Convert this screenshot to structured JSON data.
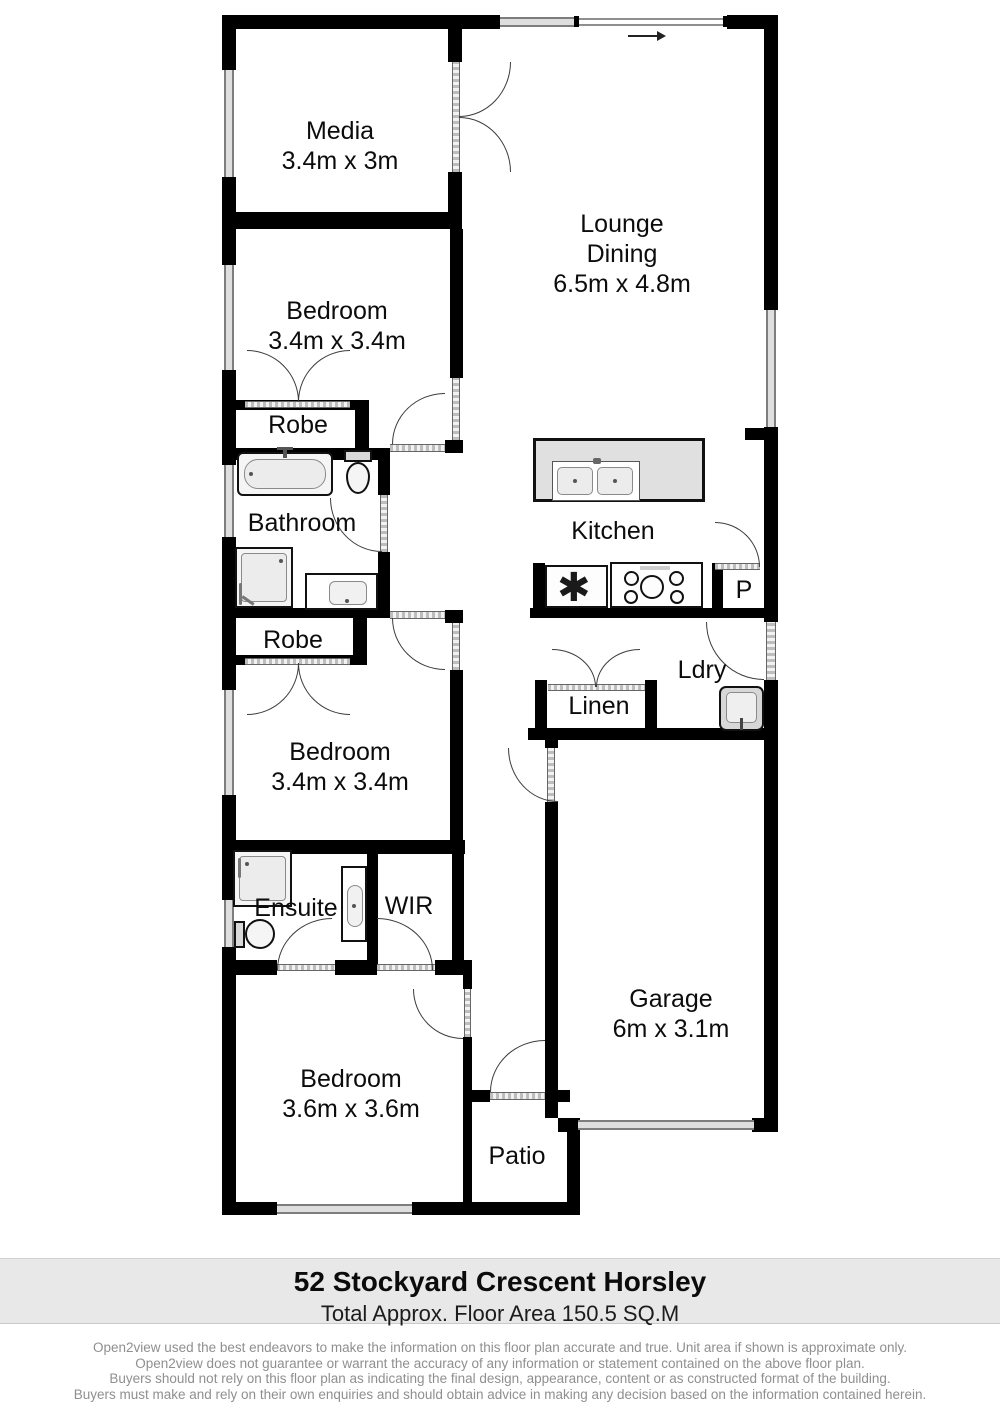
{
  "plan_title": "Floor plan",
  "rooms": {
    "media": {
      "name": "Media",
      "dims": "3.4m x 3m"
    },
    "lounge": {
      "name": "Lounge",
      "name2": "Dining",
      "dims": "6.5m x 4.8m"
    },
    "bedroom1": {
      "name": "Bedroom",
      "dims": "3.4m x 3.4m"
    },
    "robe1": {
      "name": "Robe"
    },
    "bathroom": {
      "name": "Bathroom"
    },
    "robe2": {
      "name": "Robe"
    },
    "bedroom2": {
      "name": "Bedroom",
      "dims": "3.4m x 3.4m"
    },
    "kitchen": {
      "name": "Kitchen",
      "appliance_symbol": "✱"
    },
    "pantry": {
      "name": "P"
    },
    "laundry": {
      "name": "Ldry"
    },
    "linen": {
      "name": "Linen"
    },
    "ensuite": {
      "name": "Ensuite"
    },
    "wir": {
      "name": "WIR"
    },
    "bedroom3": {
      "name": "Bedroom",
      "dims": "3.6m x 3.6m"
    },
    "garage": {
      "name": "Garage",
      "dims": "6m x 3.1m"
    },
    "patio": {
      "name": "Patio"
    }
  },
  "footer": {
    "address": "52 Stockyard Crescent Horsley",
    "area": "Total Approx. Floor Area 150.5 SQ.M",
    "disclaimer": [
      "Open2view used the best endeavors to make the information on this floor plan accurate and true. Unit area if shown is approximate only.",
      "Open2view does not guarantee or warrant the accuracy of any information or statement contained on the above floor plan.",
      "Buyers should not rely on this floor plan as indicating the final design, appearance, content or as constructed format of the building.",
      "Buyers must make and rely on their own enquiries and should obtain advice in making any decision based on the information contained herein."
    ]
  },
  "colors": {
    "wall": "#000000",
    "window_band": "#dedede",
    "door_arc": "#3c3c3c",
    "footer_band": "#e8e8e8",
    "disclaimer_text": "#8f8f8f"
  }
}
